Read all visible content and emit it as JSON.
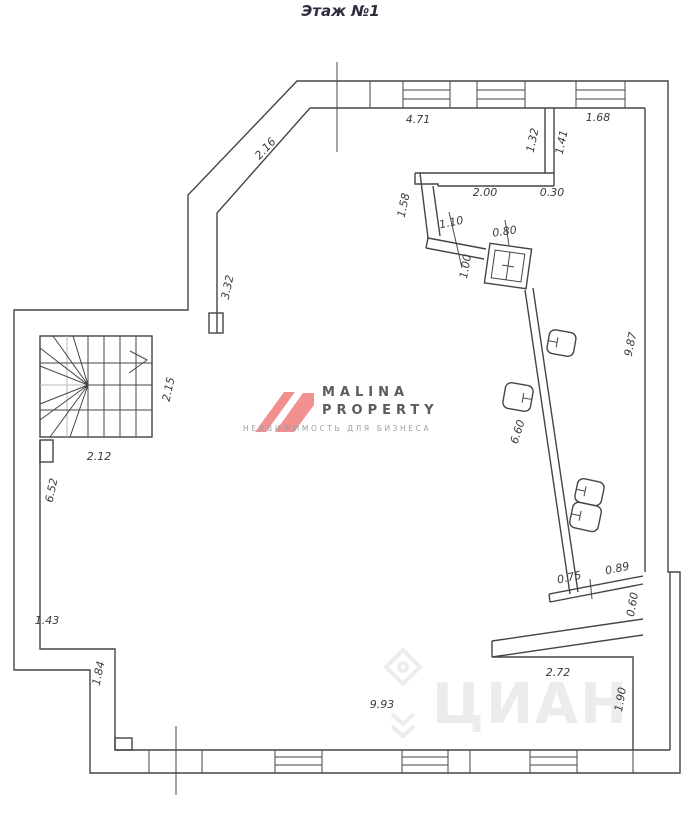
{
  "title": "Этаж №1",
  "watermark_malina": {
    "line1": "MALINA",
    "line2": "PROPERTY",
    "subtitle": "НЕДВИЖИМОСТЬ ДЛЯ БИЗНЕСА",
    "logo_color": "#f29090",
    "text_color": "#575c60",
    "subtitle_color": "#9ba1a6"
  },
  "watermark_cian": {
    "text": "ЦИАН",
    "color": "#ececec"
  },
  "plan": {
    "wall_color": "#454545",
    "dim_color": "#3a3a3a",
    "dimensions_m": [
      {
        "label": "4.71",
        "x": 418,
        "y": 123,
        "rot": 0
      },
      {
        "label": "1.68",
        "x": 598,
        "y": 121,
        "rot": 0
      },
      {
        "label": "2.16",
        "x": 268,
        "y": 151,
        "rot": -47
      },
      {
        "label": "1.32",
        "x": 536,
        "y": 141,
        "rot": -78
      },
      {
        "label": "1.41",
        "x": 565,
        "y": 143,
        "rot": -78
      },
      {
        "label": "2.00",
        "x": 485,
        "y": 196,
        "rot": 0
      },
      {
        "label": "0.30",
        "x": 552,
        "y": 196,
        "rot": 0
      },
      {
        "label": "1.58",
        "x": 407,
        "y": 206,
        "rot": -78
      },
      {
        "label": "1.10",
        "x": 452,
        "y": 226,
        "rot": -12
      },
      {
        "label": "0.80",
        "x": 505,
        "y": 235,
        "rot": -8
      },
      {
        "label": "1.00",
        "x": 469,
        "y": 267,
        "rot": -80
      },
      {
        "label": "3.32",
        "x": 231,
        "y": 288,
        "rot": -78
      },
      {
        "label": "9.87",
        "x": 634,
        "y": 345,
        "rot": -78
      },
      {
        "label": "2.15",
        "x": 172,
        "y": 390,
        "rot": -78
      },
      {
        "label": "6.60",
        "x": 521,
        "y": 433,
        "rot": -72
      },
      {
        "label": "2.12",
        "x": 99,
        "y": 460,
        "rot": 0
      },
      {
        "label": "6.52",
        "x": 55,
        "y": 491,
        "rot": -78
      },
      {
        "label": "0.75",
        "x": 570,
        "y": 581,
        "rot": -12
      },
      {
        "label": "0.89",
        "x": 618,
        "y": 572,
        "rot": -12
      },
      {
        "label": "0.60",
        "x": 636,
        "y": 605,
        "rot": -80
      },
      {
        "label": "1.43",
        "x": 47,
        "y": 624,
        "rot": 0
      },
      {
        "label": "2.72",
        "x": 558,
        "y": 676,
        "rot": 0
      },
      {
        "label": "1.84",
        "x": 102,
        "y": 674,
        "rot": -78
      },
      {
        "label": "1.90",
        "x": 624,
        "y": 700,
        "rot": -80
      },
      {
        "label": "9.93",
        "x": 382,
        "y": 708,
        "rot": 0
      }
    ]
  }
}
